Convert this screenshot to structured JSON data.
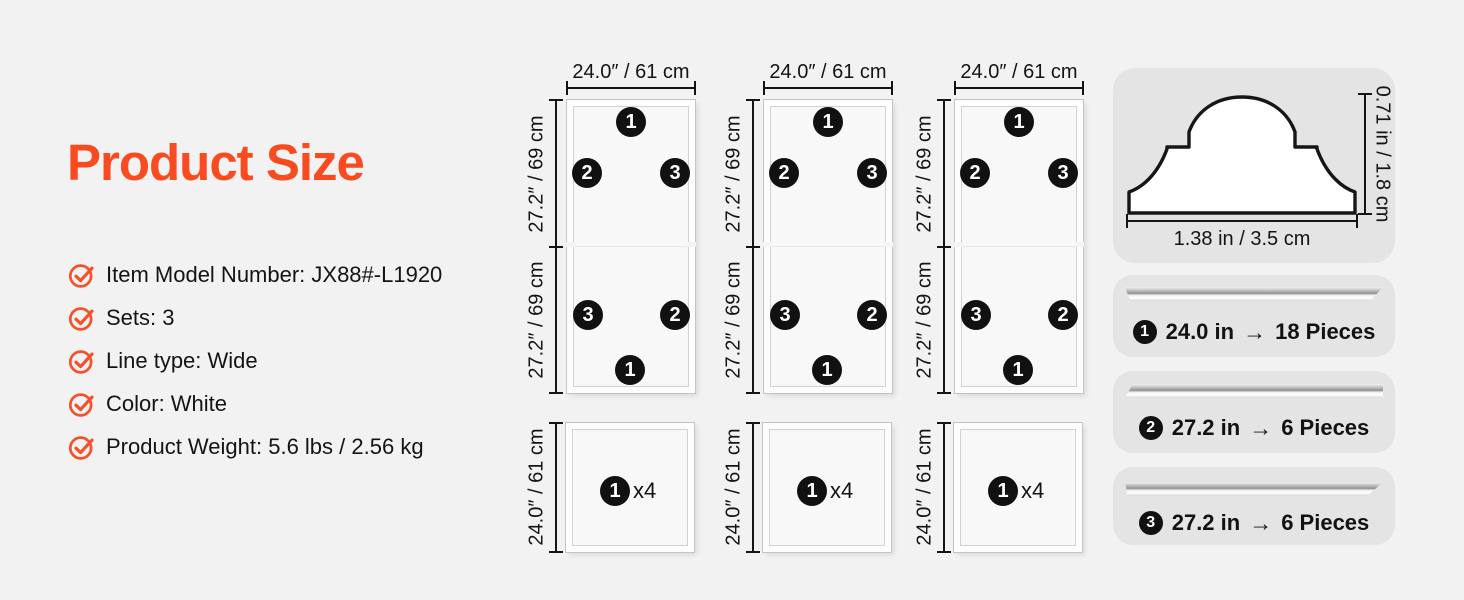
{
  "title": "Product Size",
  "specs": [
    "Item Model Number: JX88#-L1920",
    "Sets: 3",
    "Line type: Wide",
    "Color: White",
    "Product Weight: 5.6 lbs / 2.56 kg"
  ],
  "badges": {
    "n1": "1",
    "n2": "2",
    "n3": "3"
  },
  "columns": [
    {
      "top_label": "24.0″ / 61 cm",
      "upper_side_label": "27.2″ / 69 cm",
      "lower_side_label": "27.2″ / 69 cm",
      "square_side_label": "24.0″ / 61 cm",
      "square_count": "x4"
    },
    {
      "top_label": "24.0″ / 61 cm",
      "upper_side_label": "27.2″ / 69 cm",
      "lower_side_label": "27.2″ / 69 cm",
      "square_side_label": "24.0″ / 61 cm",
      "square_count": "x4"
    },
    {
      "top_label": "24.0″ / 61 cm",
      "upper_side_label": "27.2″ / 69 cm",
      "lower_side_label": "27.2″ / 69 cm",
      "square_side_label": "24.0″ / 61 cm",
      "square_count": "x4"
    }
  ],
  "profile": {
    "height_label": "0.71 in / 1.8 cm",
    "width_label": "1.38 in / 3.5 cm"
  },
  "pieces": [
    {
      "num": "1",
      "length": "24.0 in",
      "arrow": "→",
      "count": "18 Pieces"
    },
    {
      "num": "2",
      "length": "27.2 in",
      "arrow": "→",
      "count": "6 Pieces"
    },
    {
      "num": "3",
      "length": "27.2 in",
      "arrow": "→",
      "count": "6 Pieces"
    }
  ],
  "colors": {
    "accent_orange": "#f84b1f",
    "badge_black": "#111111",
    "card_gray": "#e4e4e4",
    "background": "#f2f2f2",
    "dim_line": "#151515"
  }
}
